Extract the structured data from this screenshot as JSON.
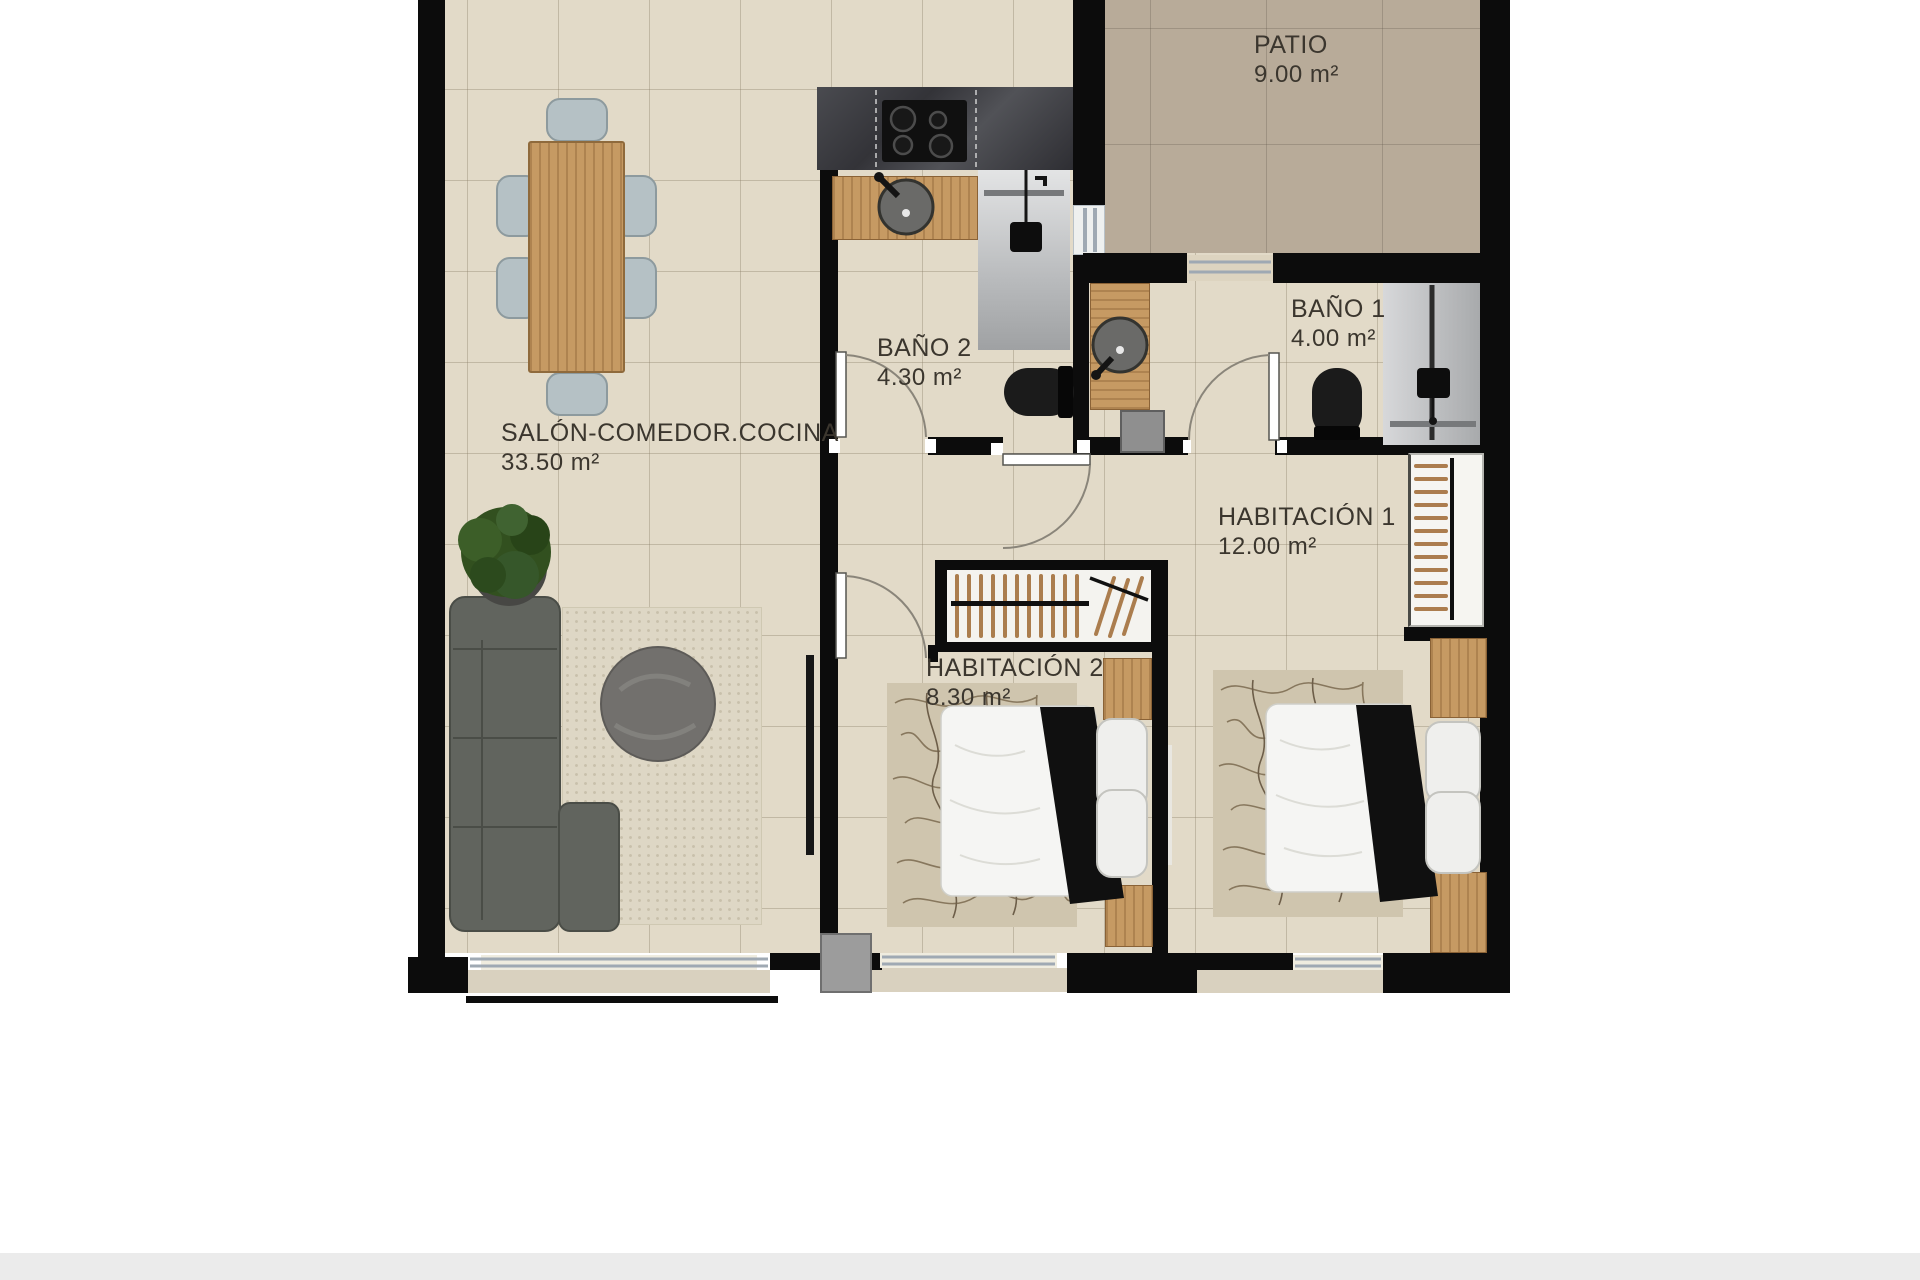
{
  "rooms": [
    {
      "name": "SALÓN-COMEDOR.COCINA",
      "area": "33.50 m²"
    },
    {
      "name": "PATIO",
      "area": "9.00 m²"
    },
    {
      "name": "BAÑO 2",
      "area": "4.30 m²"
    },
    {
      "name": "BAÑO 1",
      "area": "4.00 m²"
    },
    {
      "name": "HABITACIÓN 1",
      "area": "12.00 m²"
    },
    {
      "name": "HABITACIÓN 2",
      "area": "8.30 m²"
    }
  ],
  "colors": {
    "wall": "#0c0c0c",
    "floor": "#e2dac8",
    "patio_floor": "#b8ab99",
    "wood": "#c69a63",
    "label_text": "#3b362e",
    "window_frame": "#9fa9b3",
    "footer_bar": "#ebebeb"
  }
}
